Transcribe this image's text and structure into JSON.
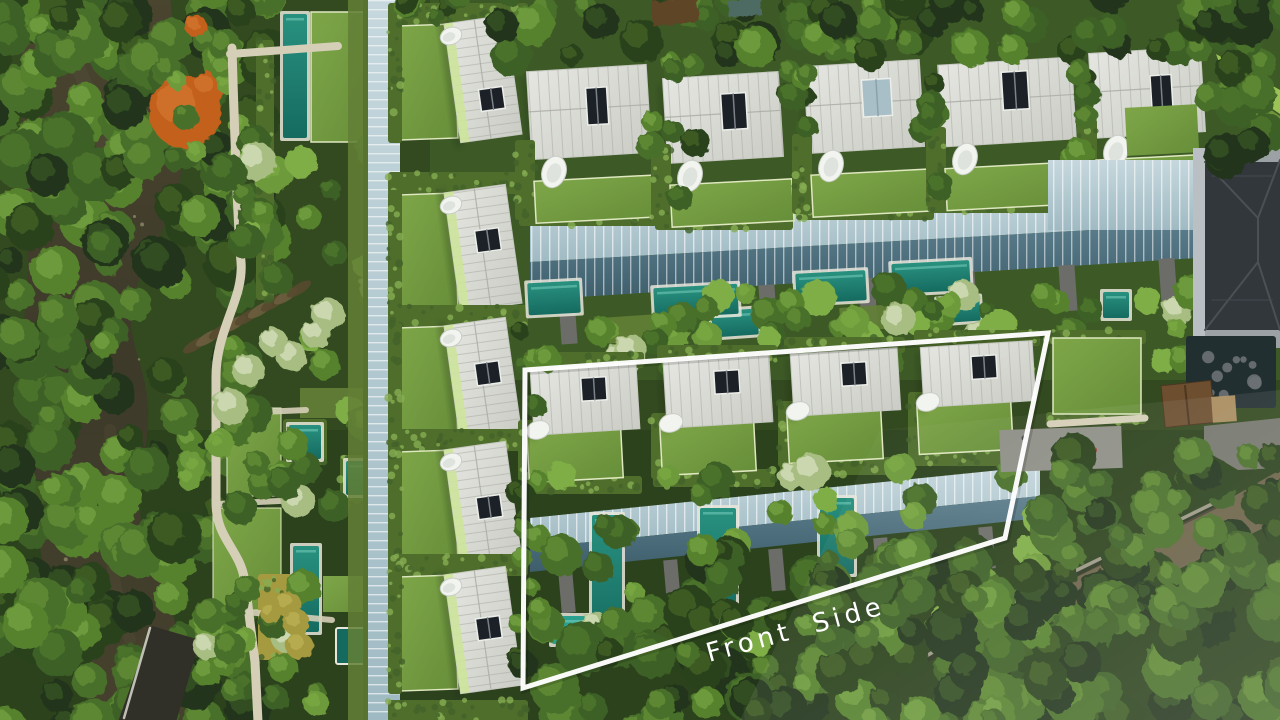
{
  "annotation": {
    "label": "Front Side",
    "color": "#ffffff"
  },
  "palette": {
    "foliage_dark": "#22351a",
    "foliage_deep": "#2b421e",
    "foliage_mid": "#3e6126",
    "foliage_mid2": "#4a7029",
    "foliage_bright": "#57822f",
    "foliage_sun": "#6d9a3b",
    "foliage_light": "#7fae47",
    "flower_tree": "#a8bd82",
    "flower_speckle": "#e6edd6",
    "orange_tree": "#c2601f",
    "orange_tree_light": "#d97b35",
    "gold_shrub": "#a59a3f",
    "river": "#474331",
    "river_dark": "#3a3728",
    "river_light": "#575139",
    "sand_bank": "#8a7850",
    "debris": "#6b5d3d",
    "lawn": "#71953e",
    "lawn_bright": "#82a84b",
    "lawn_dark": "#637f36",
    "hedge": "#4f6e2c",
    "hedge_light": "#86ac52",
    "roof_white": "#d9dad5",
    "roof_bright": "#e3e4df",
    "roof_shade": "#cdcfc8",
    "roof_seam": "#a7aaa2",
    "roof_green_strip": "#cde49b",
    "skylight": "#1c2127",
    "skylight_frame": "#eceeea",
    "glass_pale": "#bdd1d8",
    "glass_mid": "#8fb0ba",
    "glass_deep": "#4f707e",
    "mullion": "#f4f7f7",
    "pier_gray": "#6c6c68",
    "pool": "#1f8274",
    "pool_bright": "#2ba08f",
    "pool_dark": "#146a5e",
    "pond_dark": "#222f31",
    "rock_gray": "#6b7174",
    "path": "#d5cfb8",
    "road_dark": "#302f28",
    "road_gray": "#75766c",
    "dirt": "#6e6349",
    "building_roof": "#32373c",
    "building_ridge": "#4a5056",
    "building_wall": "#9ba1a4",
    "hut_roof": "#6d4f30",
    "stone_wall": "#9a9784",
    "tub_white": "#f2f4f0",
    "haze": "#ffffff"
  }
}
